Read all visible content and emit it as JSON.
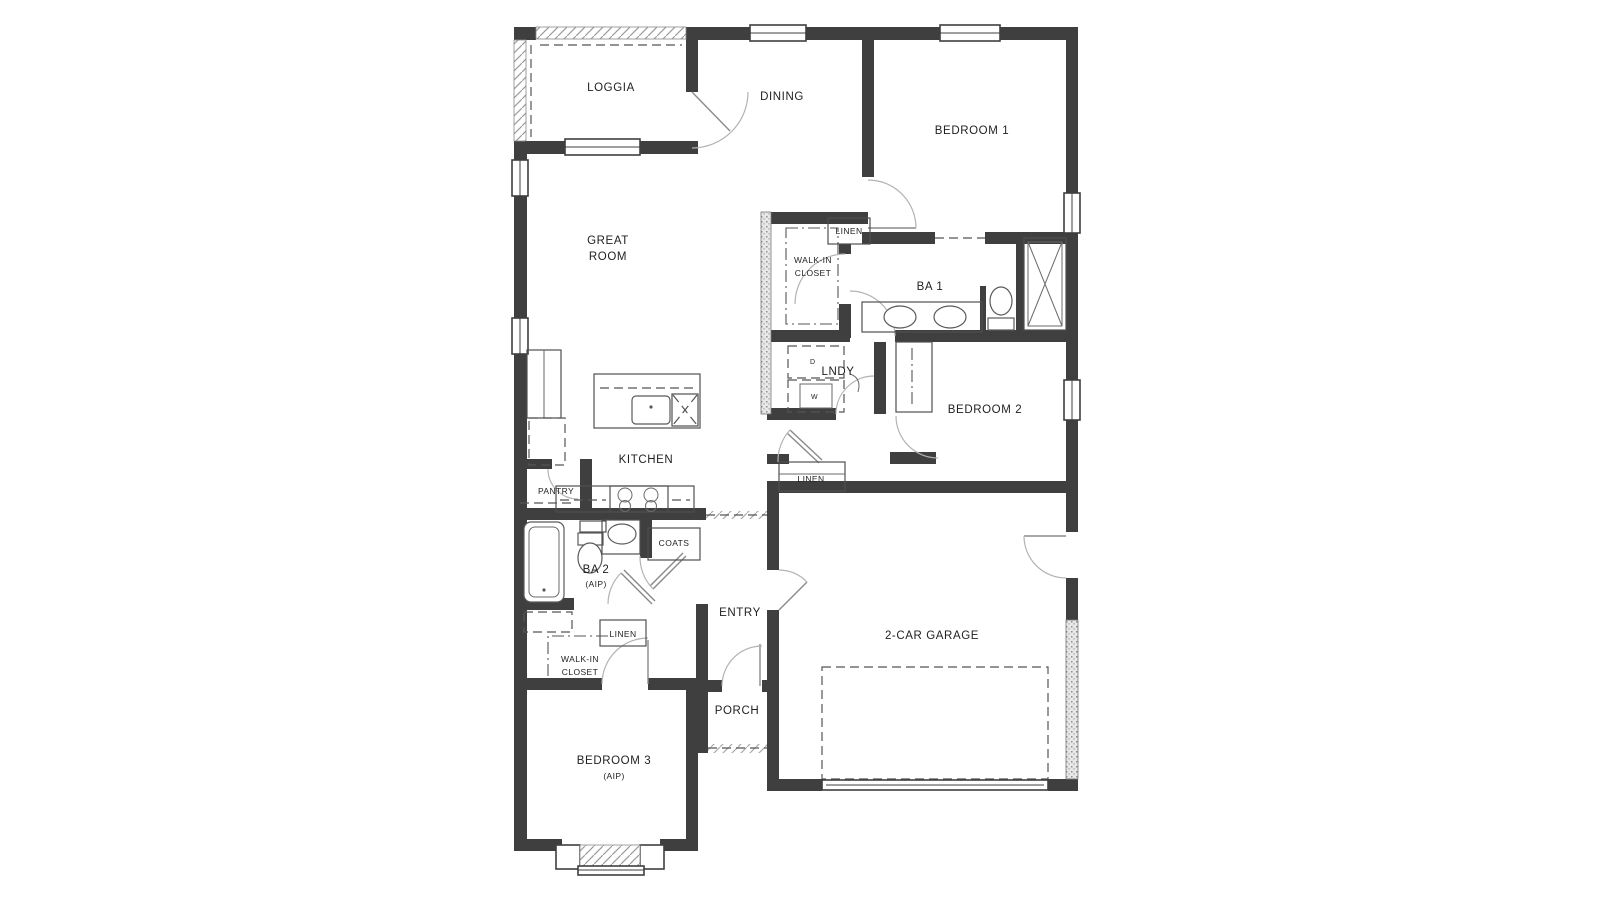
{
  "canvas": {
    "width": 1600,
    "height": 900,
    "background": "#ffffff"
  },
  "colors": {
    "wall": "#3f3f3f",
    "thin_line": "#4f4f4f",
    "door_arc": "#b3b3b3",
    "dashed_line": "#555555",
    "hatch": "#9b9b9b",
    "text": "#1f1f1f",
    "background": "#ffffff"
  },
  "rooms": {
    "loggia": {
      "label": "LOGGIA"
    },
    "dining": {
      "label": "DINING"
    },
    "bedroom_1": {
      "label": "BEDROOM 1"
    },
    "great_room": {
      "line1": "GREAT",
      "line2": "ROOM"
    },
    "walk_in_closet_1": {
      "line1": "WALK-IN",
      "line2": "CLOSET"
    },
    "linen_bath_1": {
      "label": "LINEN"
    },
    "bath_1": {
      "label": "BA 1"
    },
    "laundry": {
      "label": "LNDY"
    },
    "bedroom_2": {
      "label": "BEDROOM 2"
    },
    "linen_hall": {
      "label": "LINEN"
    },
    "kitchen": {
      "label": "KITCHEN"
    },
    "pantry": {
      "label": "PANTRY"
    },
    "coats": {
      "label": "COATS"
    },
    "bath_2": {
      "label": "BA 2",
      "sublabel": "(AIP)"
    },
    "linen_2": {
      "label": "LINEN"
    },
    "walk_in_closet_2": {
      "line1": "WALK-IN",
      "line2": "CLOSET"
    },
    "entry": {
      "label": "ENTRY"
    },
    "porch": {
      "label": "PORCH"
    },
    "garage": {
      "label": "2-CAR GARAGE"
    },
    "bedroom_3": {
      "label": "BEDROOM 3",
      "sublabel": "(AIP)"
    }
  },
  "appliances": {
    "dryer": "D",
    "washer": "W"
  }
}
